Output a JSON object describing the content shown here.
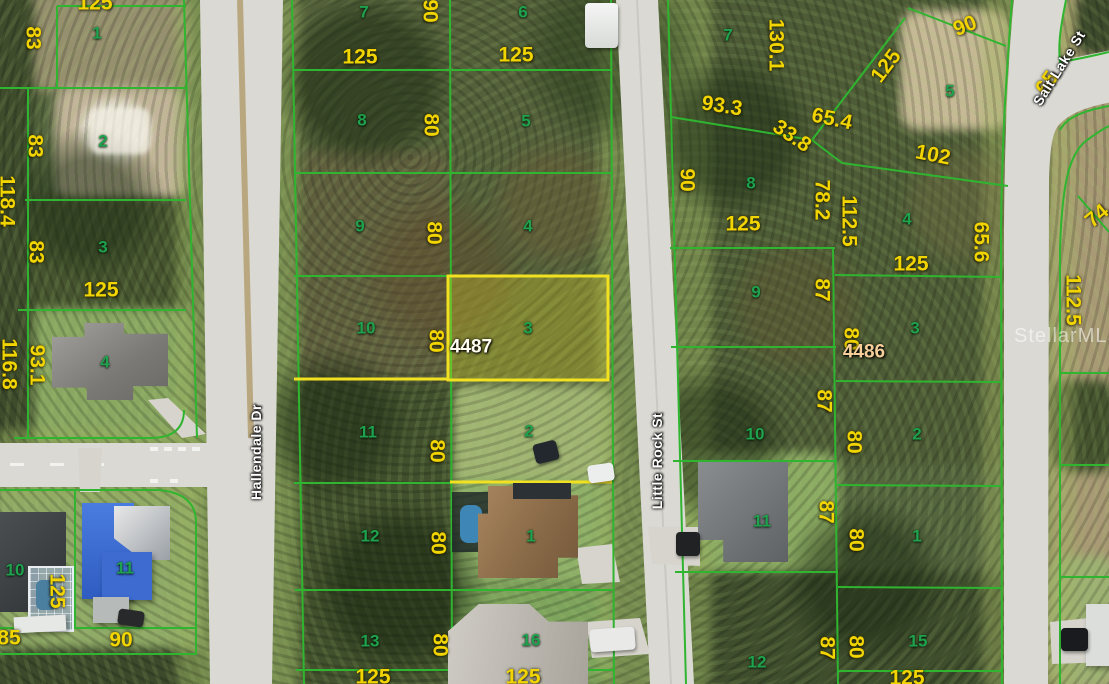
{
  "map": {
    "watermark": "StellarMLS",
    "subject_parcels": [
      {
        "id": "4487",
        "x": 471,
        "y": 347
      },
      {
        "id": "4486",
        "x": 864,
        "y": 352
      }
    ],
    "streets": [
      {
        "name": "Hallendale Dr",
        "x": 256,
        "y": 452,
        "rot": -90
      },
      {
        "name": "Little Rock St",
        "x": 657,
        "y": 461,
        "rot": -90
      },
      {
        "name": "Salt Lake St",
        "x": 1059,
        "y": 68,
        "rot": -58
      }
    ],
    "lot_numbers": [
      {
        "text": "1",
        "x": 97,
        "y": 33
      },
      {
        "text": "2",
        "x": 103,
        "y": 141
      },
      {
        "text": "3",
        "x": 103,
        "y": 247
      },
      {
        "text": "4",
        "x": 105,
        "y": 362
      },
      {
        "text": "10",
        "x": 15,
        "y": 570
      },
      {
        "text": "11",
        "x": 125,
        "y": 568
      },
      {
        "text": "7",
        "x": 364,
        "y": 12
      },
      {
        "text": "8",
        "x": 362,
        "y": 120
      },
      {
        "text": "9",
        "x": 360,
        "y": 226
      },
      {
        "text": "10",
        "x": 366,
        "y": 328
      },
      {
        "text": "11",
        "x": 368,
        "y": 432
      },
      {
        "text": "12",
        "x": 370,
        "y": 536
      },
      {
        "text": "13",
        "x": 370,
        "y": 641
      },
      {
        "text": "6",
        "x": 523,
        "y": 12
      },
      {
        "text": "5",
        "x": 526,
        "y": 121
      },
      {
        "text": "4",
        "x": 528,
        "y": 226
      },
      {
        "text": "3",
        "x": 528,
        "y": 328
      },
      {
        "text": "2",
        "x": 529,
        "y": 431
      },
      {
        "text": "1",
        "x": 531,
        "y": 536
      },
      {
        "text": "16",
        "x": 531,
        "y": 640
      },
      {
        "text": "7",
        "x": 728,
        "y": 35
      },
      {
        "text": "8",
        "x": 751,
        "y": 183
      },
      {
        "text": "9",
        "x": 756,
        "y": 292
      },
      {
        "text": "10",
        "x": 755,
        "y": 434
      },
      {
        "text": "11",
        "x": 762,
        "y": 521
      },
      {
        "text": "12",
        "x": 757,
        "y": 662
      },
      {
        "text": "5",
        "x": 950,
        "y": 91
      },
      {
        "text": "4",
        "x": 907,
        "y": 219
      },
      {
        "text": "3",
        "x": 915,
        "y": 328
      },
      {
        "text": "2",
        "x": 917,
        "y": 434
      },
      {
        "text": "1",
        "x": 917,
        "y": 536
      },
      {
        "text": "15",
        "x": 918,
        "y": 641
      }
    ],
    "dimensions": [
      {
        "text": "125",
        "x": 95,
        "y": 3,
        "rot": 0
      },
      {
        "text": "83",
        "x": 33,
        "y": 38,
        "rot": 90
      },
      {
        "text": "83",
        "x": 35,
        "y": 146,
        "rot": 90
      },
      {
        "text": "118.4",
        "x": 7,
        "y": 201,
        "rot": 90
      },
      {
        "text": "83",
        "x": 36,
        "y": 252,
        "rot": 90
      },
      {
        "text": "125",
        "x": 101,
        "y": 290,
        "rot": 0
      },
      {
        "text": "116.8",
        "x": 9,
        "y": 364,
        "rot": 90
      },
      {
        "text": "93.1",
        "x": 37,
        "y": 365,
        "rot": 90
      },
      {
        "text": "125",
        "x": 57,
        "y": 591,
        "rot": 90
      },
      {
        "text": "85",
        "x": 9,
        "y": 638,
        "rot": 0
      },
      {
        "text": "90",
        "x": 121,
        "y": 640,
        "rot": 0
      },
      {
        "text": "125",
        "x": 360,
        "y": 57,
        "rot": 0
      },
      {
        "text": "125",
        "x": 516,
        "y": 55,
        "rot": 0
      },
      {
        "text": "90",
        "x": 430,
        "y": 11,
        "rot": 90
      },
      {
        "text": "80",
        "x": 431,
        "y": 125,
        "rot": 90
      },
      {
        "text": "80",
        "x": 434,
        "y": 233,
        "rot": 90
      },
      {
        "text": "80",
        "x": 436,
        "y": 341,
        "rot": 90
      },
      {
        "text": "80",
        "x": 437,
        "y": 451,
        "rot": 90
      },
      {
        "text": "80",
        "x": 438,
        "y": 543,
        "rot": 90
      },
      {
        "text": "80",
        "x": 440,
        "y": 645,
        "rot": 90
      },
      {
        "text": "125",
        "x": 373,
        "y": 677,
        "rot": 0
      },
      {
        "text": "125",
        "x": 523,
        "y": 677,
        "rot": 0
      },
      {
        "text": "130.1",
        "x": 776,
        "y": 45,
        "rot": 90
      },
      {
        "text": "93.3",
        "x": 722,
        "y": 106,
        "rot": 9
      },
      {
        "text": "65.4",
        "x": 832,
        "y": 119,
        "rot": 12
      },
      {
        "text": "33.8",
        "x": 792,
        "y": 136,
        "rot": 34
      },
      {
        "text": "102",
        "x": 933,
        "y": 155,
        "rot": 11
      },
      {
        "text": "125",
        "x": 886,
        "y": 66,
        "rot": -53
      },
      {
        "text": "90",
        "x": 965,
        "y": 26,
        "rot": -22
      },
      {
        "text": "90",
        "x": 687,
        "y": 180,
        "rot": 90
      },
      {
        "text": "125",
        "x": 743,
        "y": 224,
        "rot": 0
      },
      {
        "text": "78.2",
        "x": 822,
        "y": 200,
        "rot": 90
      },
      {
        "text": "112.5",
        "x": 849,
        "y": 221,
        "rot": 90
      },
      {
        "text": "125",
        "x": 911,
        "y": 264,
        "rot": 0
      },
      {
        "text": "65.6",
        "x": 981,
        "y": 242,
        "rot": 90
      },
      {
        "text": "87",
        "x": 822,
        "y": 290,
        "rot": 90
      },
      {
        "text": "80",
        "x": 851,
        "y": 339,
        "rot": 90
      },
      {
        "text": "87",
        "x": 824,
        "y": 401,
        "rot": 90
      },
      {
        "text": "80",
        "x": 854,
        "y": 442,
        "rot": 90
      },
      {
        "text": "87",
        "x": 826,
        "y": 512,
        "rot": 90
      },
      {
        "text": "80",
        "x": 856,
        "y": 540,
        "rot": 90
      },
      {
        "text": "87",
        "x": 827,
        "y": 648,
        "rot": 90
      },
      {
        "text": "80",
        "x": 856,
        "y": 647,
        "rot": 90
      },
      {
        "text": "125",
        "x": 907,
        "y": 678,
        "rot": 0
      },
      {
        "text": "112.5",
        "x": 1073,
        "y": 300,
        "rot": 90
      },
      {
        "text": "74",
        "x": 1097,
        "y": 216,
        "rot": -40
      },
      {
        "text": "65",
        "x": 1047,
        "y": 83,
        "rot": -55
      }
    ],
    "colors": {
      "parcel_line": "#2fb52f",
      "highlight_line": "#f2e120",
      "highlight_fill": "rgba(240,225,40,0.28)",
      "dimension_text": "#f2d400",
      "lot_text": "#1ea24d",
      "street_text": "#ffffff",
      "subject_text": "#fffef0",
      "subject2_text": "#f7cf9b",
      "road": "#dad9d3"
    }
  }
}
